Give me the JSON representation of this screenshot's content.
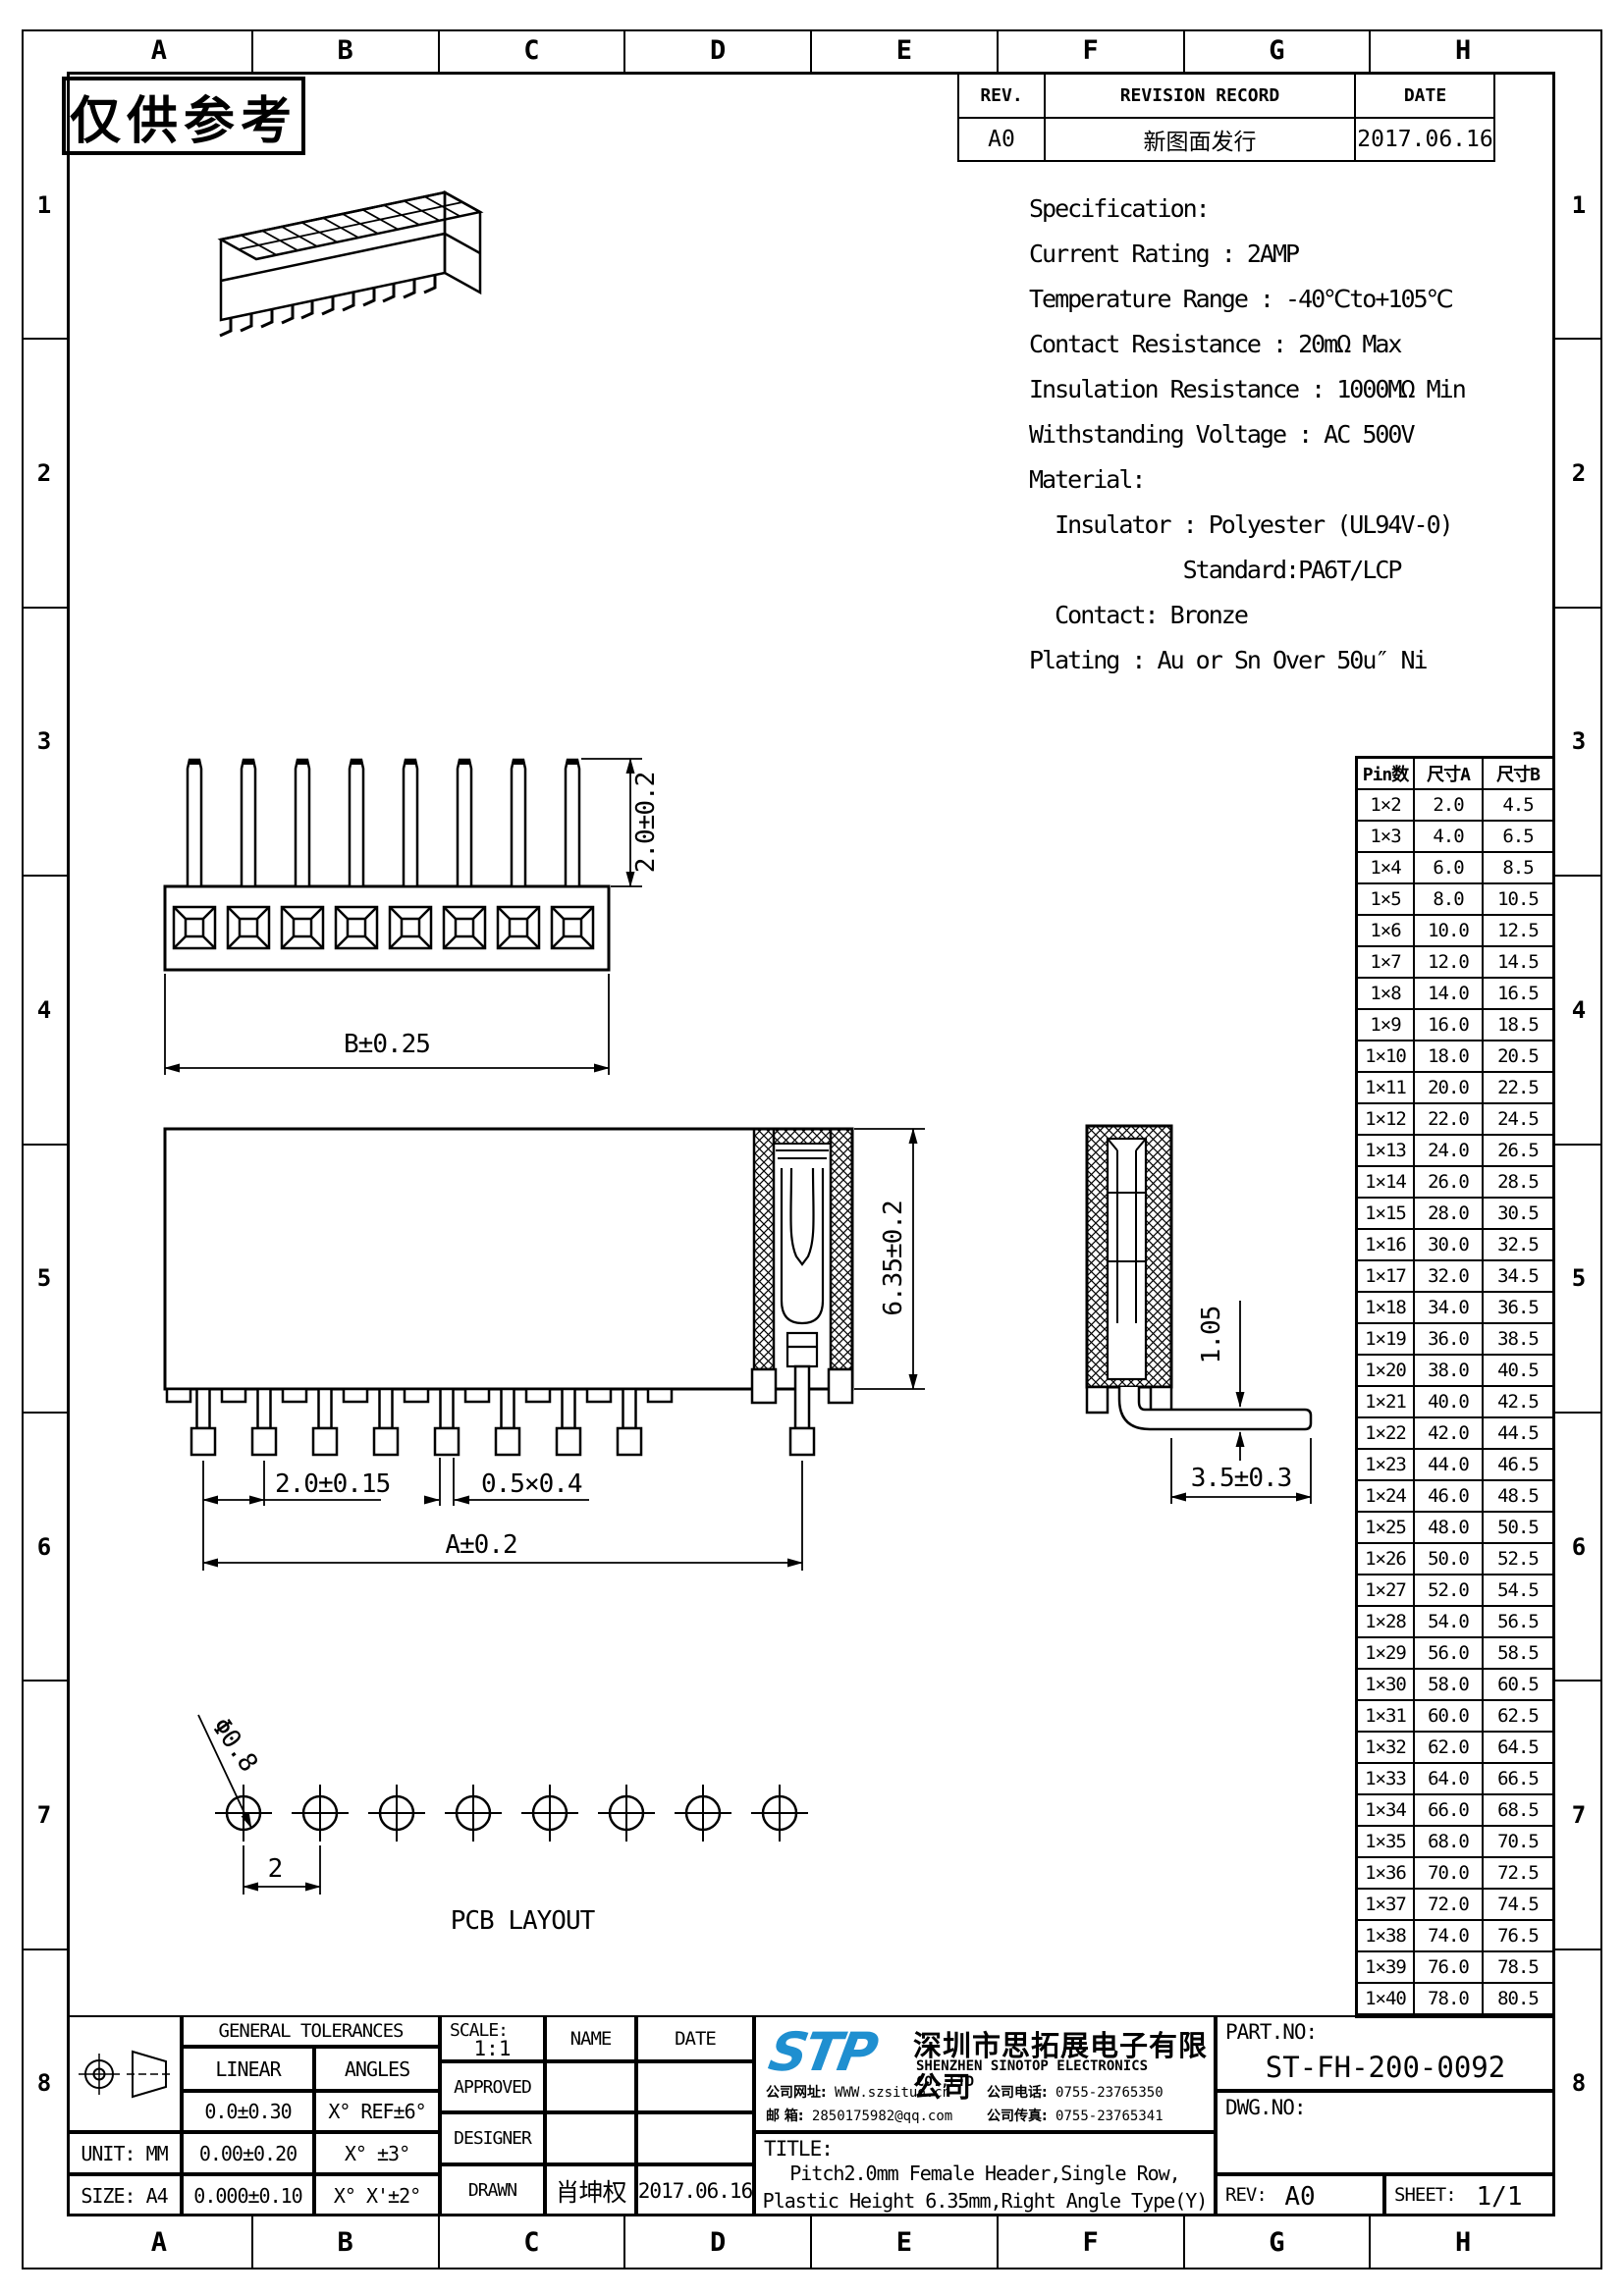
{
  "frame": {
    "columns": [
      "A",
      "B",
      "C",
      "D",
      "E",
      "F",
      "G",
      "H"
    ],
    "rows": [
      "1",
      "2",
      "3",
      "4",
      "5",
      "6",
      "7",
      "8"
    ]
  },
  "watermark": "仅供参考",
  "revision_table": {
    "headers": [
      "REV.",
      "REVISION RECORD",
      "DATE"
    ],
    "rev": "A0",
    "record": "新图面发行",
    "date": "2017.06.16"
  },
  "specification": {
    "lines": [
      "Specification:",
      "Current Rating : 2AMP",
      "Temperature Range : -40℃to+105℃",
      "Contact Resistance : 20mΩ Max",
      "Insulation Resistance : 1000MΩ Min",
      "Withstanding Voltage : AC 500V",
      "Material:",
      "  Insulator : Polyester (UL94V-0)",
      "            Standard:PA6T/LCP",
      "  Contact: Bronze",
      "Plating : Au or Sn Over 50u″ Ni"
    ]
  },
  "dimensions": {
    "pin_length": "2.0±0.2",
    "body_width": "B±0.25",
    "height": "6.35±0.2",
    "pitch": "2.0±0.15",
    "pin_section": "0.5×0.4",
    "span": "A±0.2",
    "tail_offset": "1.05",
    "tail_length": "3.5±0.3",
    "hole_dia": "Φ0.8",
    "hole_pitch": "2"
  },
  "views": {
    "pcb_label": "PCB LAYOUT"
  },
  "pin_table": {
    "headers": [
      "Pin数",
      "尺寸A",
      "尺寸B"
    ],
    "rows": [
      [
        "1×2",
        "2.0",
        "4.5"
      ],
      [
        "1×3",
        "4.0",
        "6.5"
      ],
      [
        "1×4",
        "6.0",
        "8.5"
      ],
      [
        "1×5",
        "8.0",
        "10.5"
      ],
      [
        "1×6",
        "10.0",
        "12.5"
      ],
      [
        "1×7",
        "12.0",
        "14.5"
      ],
      [
        "1×8",
        "14.0",
        "16.5"
      ],
      [
        "1×9",
        "16.0",
        "18.5"
      ],
      [
        "1×10",
        "18.0",
        "20.5"
      ],
      [
        "1×11",
        "20.0",
        "22.5"
      ],
      [
        "1×12",
        "22.0",
        "24.5"
      ],
      [
        "1×13",
        "24.0",
        "26.5"
      ],
      [
        "1×14",
        "26.0",
        "28.5"
      ],
      [
        "1×15",
        "28.0",
        "30.5"
      ],
      [
        "1×16",
        "30.0",
        "32.5"
      ],
      [
        "1×17",
        "32.0",
        "34.5"
      ],
      [
        "1×18",
        "34.0",
        "36.5"
      ],
      [
        "1×19",
        "36.0",
        "38.5"
      ],
      [
        "1×20",
        "38.0",
        "40.5"
      ],
      [
        "1×21",
        "40.0",
        "42.5"
      ],
      [
        "1×22",
        "42.0",
        "44.5"
      ],
      [
        "1×23",
        "44.0",
        "46.5"
      ],
      [
        "1×24",
        "46.0",
        "48.5"
      ],
      [
        "1×25",
        "48.0",
        "50.5"
      ],
      [
        "1×26",
        "50.0",
        "52.5"
      ],
      [
        "1×27",
        "52.0",
        "54.5"
      ],
      [
        "1×28",
        "54.0",
        "56.5"
      ],
      [
        "1×29",
        "56.0",
        "58.5"
      ],
      [
        "1×30",
        "58.0",
        "60.5"
      ],
      [
        "1×31",
        "60.0",
        "62.5"
      ],
      [
        "1×32",
        "62.0",
        "64.5"
      ],
      [
        "1×33",
        "64.0",
        "66.5"
      ],
      [
        "1×34",
        "66.0",
        "68.5"
      ],
      [
        "1×35",
        "68.0",
        "70.5"
      ],
      [
        "1×36",
        "70.0",
        "72.5"
      ],
      [
        "1×37",
        "72.0",
        "74.5"
      ],
      [
        "1×38",
        "74.0",
        "76.5"
      ],
      [
        "1×39",
        "76.0",
        "78.5"
      ],
      [
        "1×40",
        "78.0",
        "80.5"
      ]
    ]
  },
  "title_block": {
    "tolerances": {
      "title": "GENERAL TOLERANCES",
      "linear_label": "LINEAR",
      "angles_label": "ANGLES",
      "rows": [
        [
          "0.0±0.30",
          "X° REF±6°"
        ],
        [
          "0.00±0.20",
          "X° ±3°"
        ],
        [
          "0.000±0.10",
          "X° X'±2°"
        ]
      ],
      "unit": "UNIT: MM",
      "size": "SIZE: A4"
    },
    "scale_label": "SCALE:",
    "scale_value": "1:1",
    "name_label": "NAME",
    "date_label": "DATE",
    "approved_label": "APPROVED",
    "designer_label": "DESIGNER",
    "drawn_label": "DRAWN",
    "drawn_name": "肖坤权",
    "drawn_date": "2017.06.16",
    "company": {
      "logo_text": "STP",
      "logo_color": "#1f8fd0",
      "name_cn": "深圳市思拓展电子有限公司",
      "name_en": "SHENZHEN SINOTOP ELECTRONICS CO.,LTD",
      "website_label": "公司网址:",
      "website": "WWW.szsituo.cn",
      "phone_label": "公司电话:",
      "phone": "0755-23765350",
      "email_label": "邮 箱:",
      "email": "2850175982@qq.com",
      "fax_label": "公司传真:",
      "fax": "0755-23765341"
    },
    "title_label": "TITLE:",
    "title_line1": "Pitch2.0mm Female Header,Single Row,",
    "title_line2": "Plastic Height 6.35mm,Right Angle Type(Y)",
    "part_no_label": "PART.NO:",
    "part_no": "ST-FH-200-0092",
    "dwg_no_label": "DWG.NO:",
    "rev_label": "REV:",
    "rev_value": "A0",
    "sheet_label": "SHEET:",
    "sheet_value": "1/1"
  }
}
